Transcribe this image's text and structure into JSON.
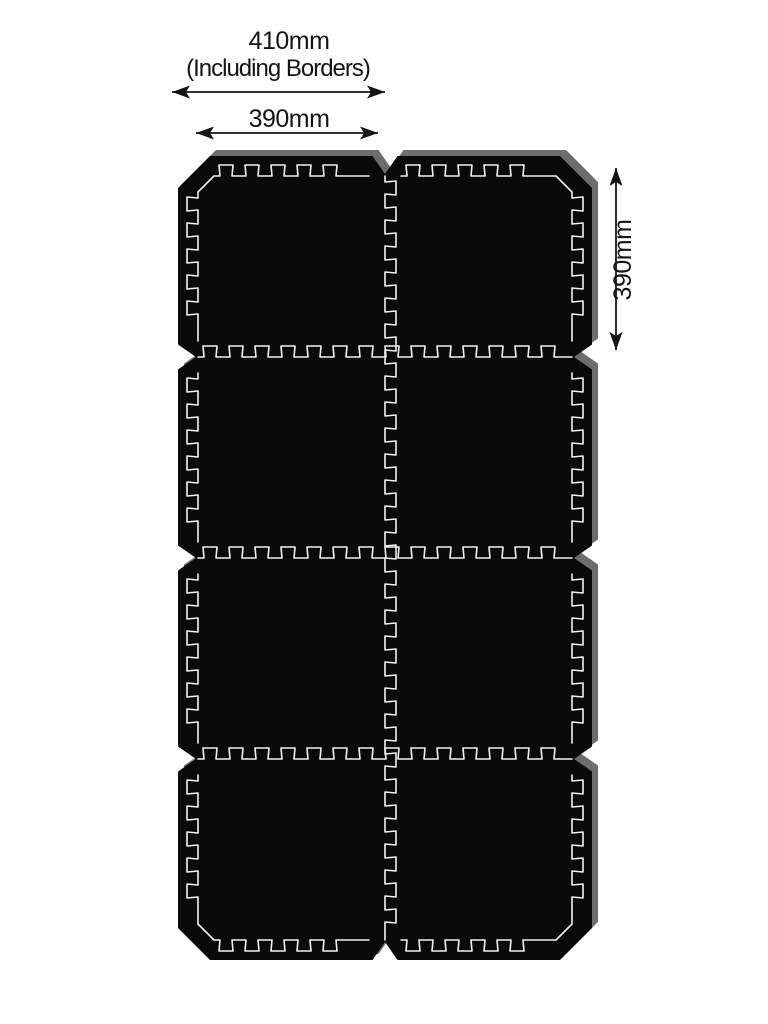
{
  "annotations": {
    "overall_width": {
      "label": "410mm",
      "sublabel": "(Including Borders)"
    },
    "tile_width": {
      "label": "390mm"
    },
    "tile_height": {
      "label": "390mm"
    }
  },
  "mat": {
    "rows": 4,
    "cols": 2,
    "tile_count": 8
  },
  "colors": {
    "mat_surface": "#0a0a0a",
    "seam_line": "#f2f2f2",
    "edge_3d": "#6d6d6d",
    "annotation": "#141414",
    "background": "#ffffff"
  }
}
